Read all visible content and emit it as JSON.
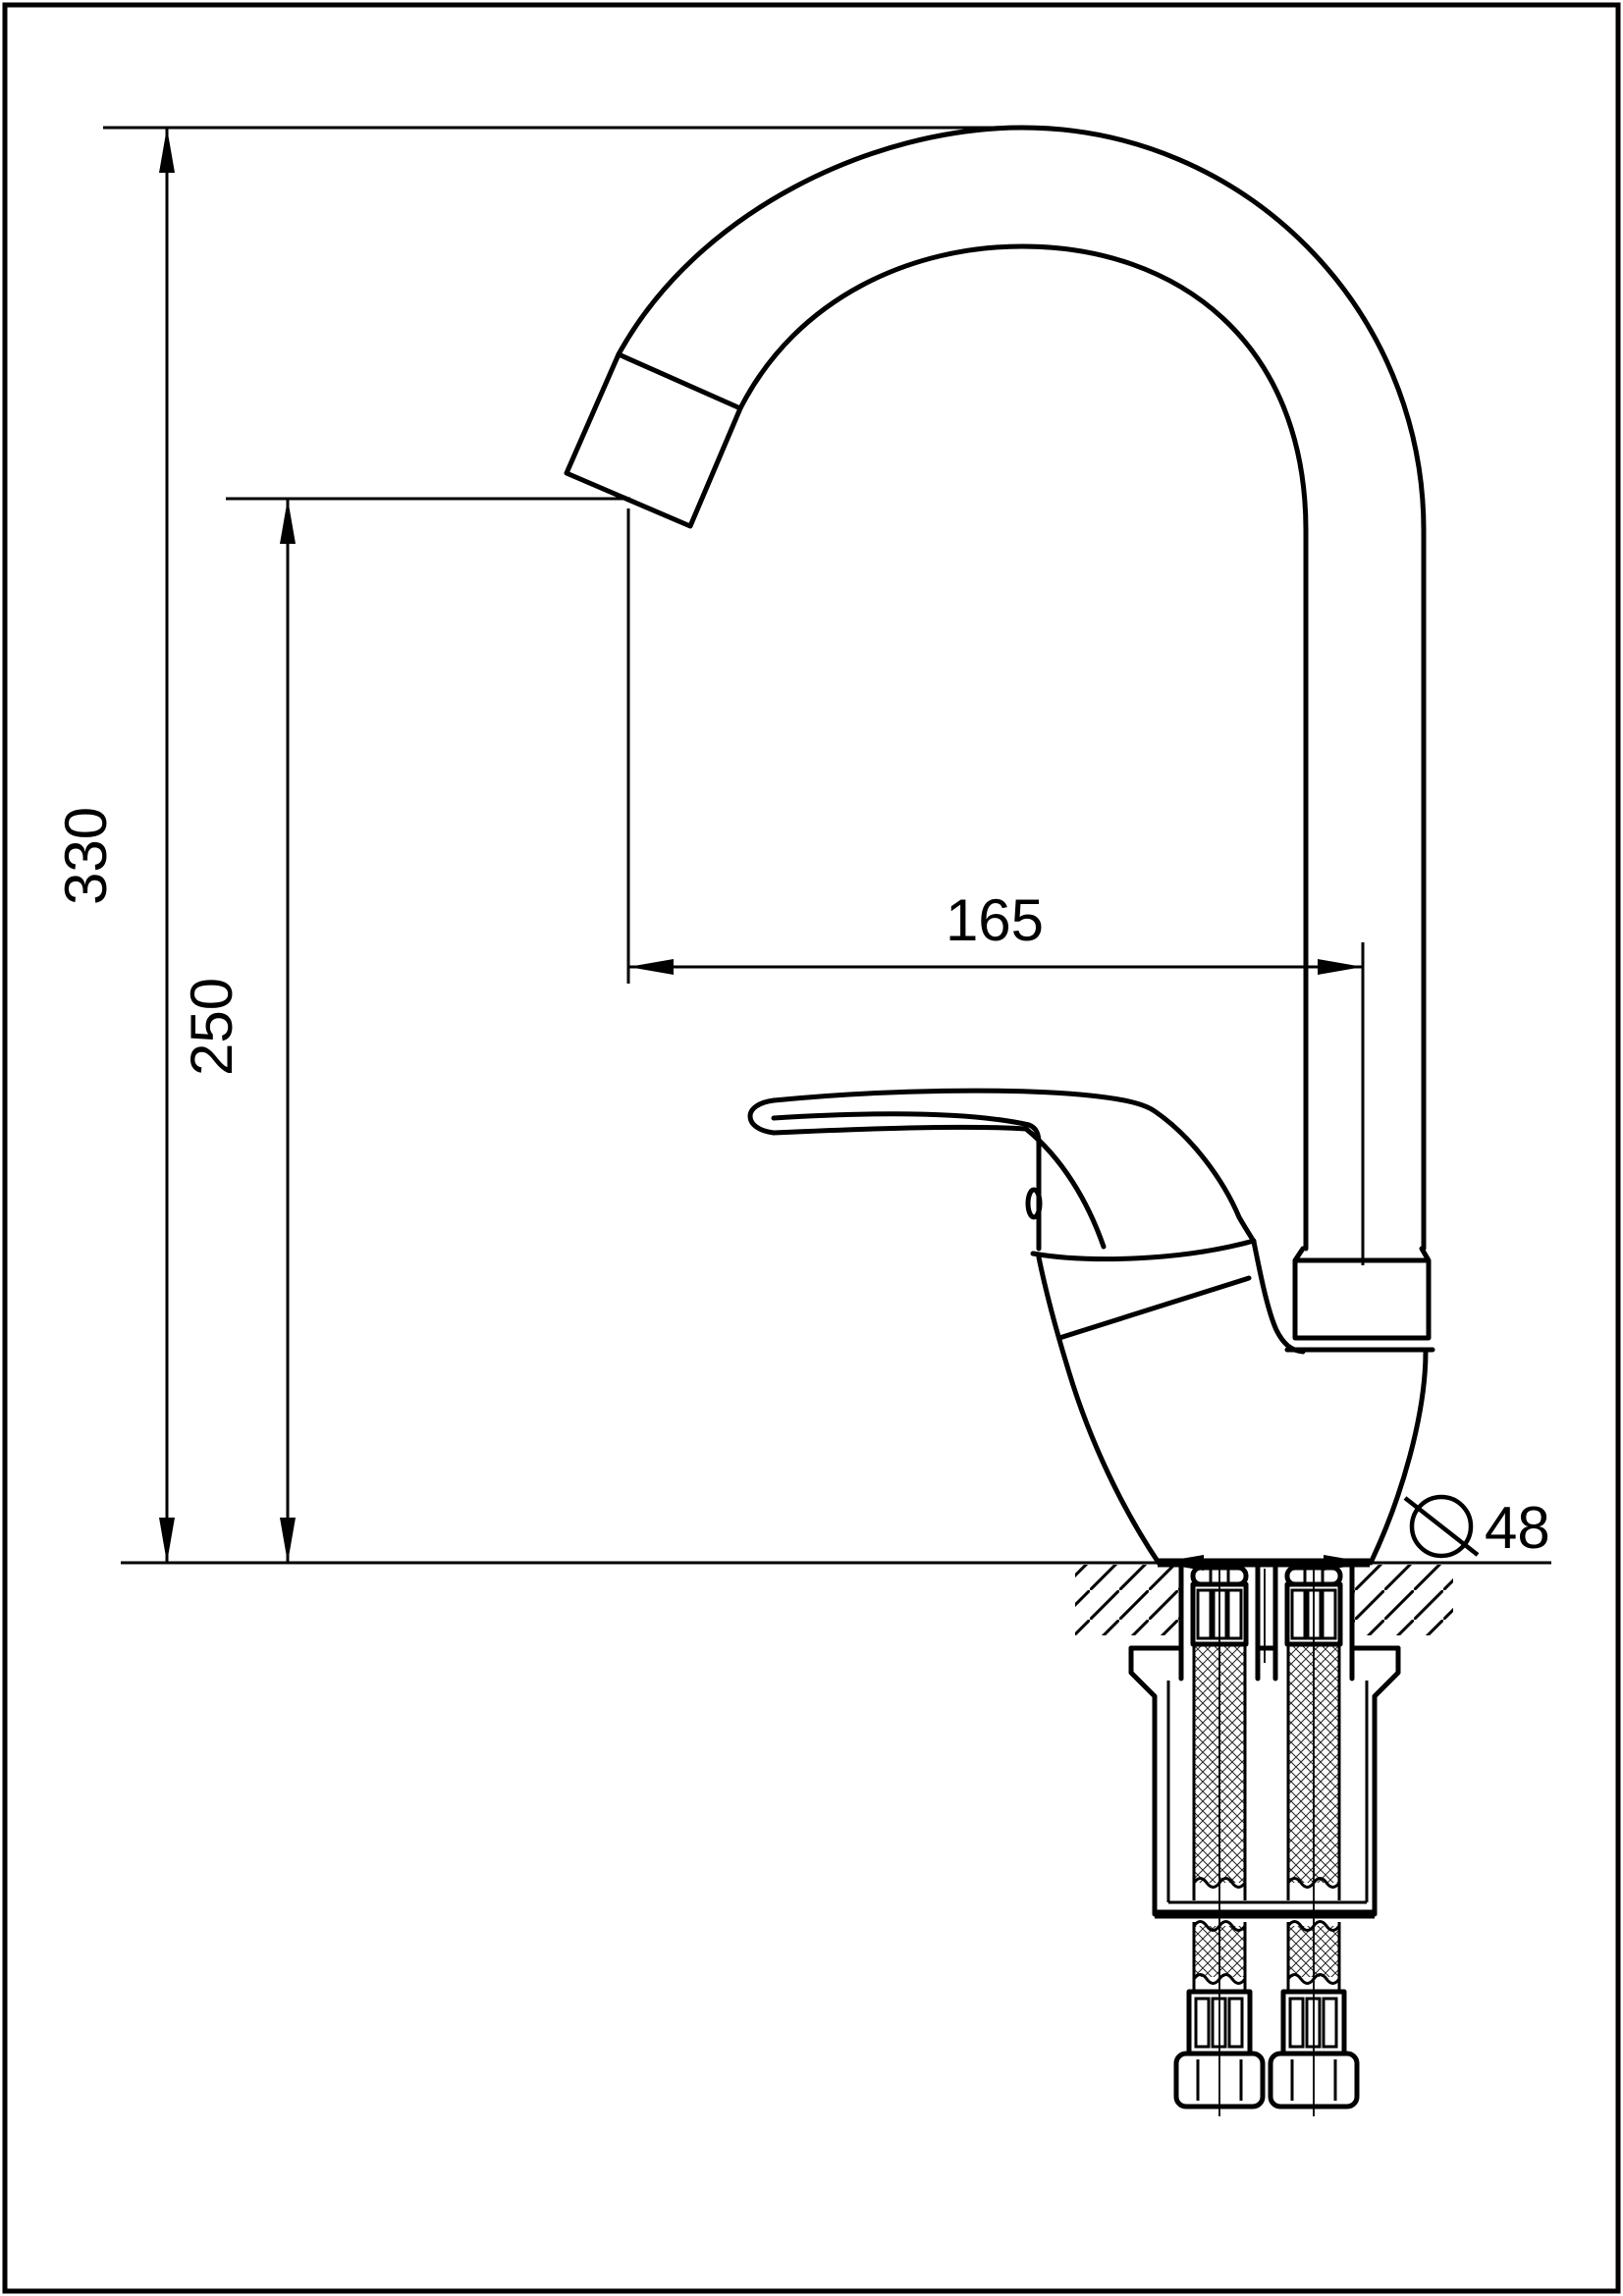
{
  "drawing": {
    "type": "technical-drawing",
    "subject": "single-lever kitchen mixer tap with high arc swivel spout, side elevation with under-counter mounting section",
    "units": "mm",
    "ink_color": "#000000",
    "paper_color": "#ffffff",
    "dimensions": {
      "height_total": {
        "value": "330",
        "orientation": "vertical",
        "measures": "counter top to top of spout arc"
      },
      "height_outlet": {
        "value": "250",
        "orientation": "vertical",
        "measures": "counter top to spout outlet"
      },
      "reach": {
        "value": "165",
        "orientation": "horizontal",
        "measures": "spout outlet to riser pipe axis"
      },
      "base_diameter": {
        "value": "48",
        "symbol": "diameter-icon",
        "orientation": "horizontal",
        "measures": "body base diameter at counter"
      }
    },
    "icons": {
      "diameter_symbol": "slashed circle (⌀)"
    },
    "hatching": {
      "counter_section": "45-degree single hatch",
      "shank_texture": "diamond cross-hatch (threaded/braided sections)"
    }
  }
}
